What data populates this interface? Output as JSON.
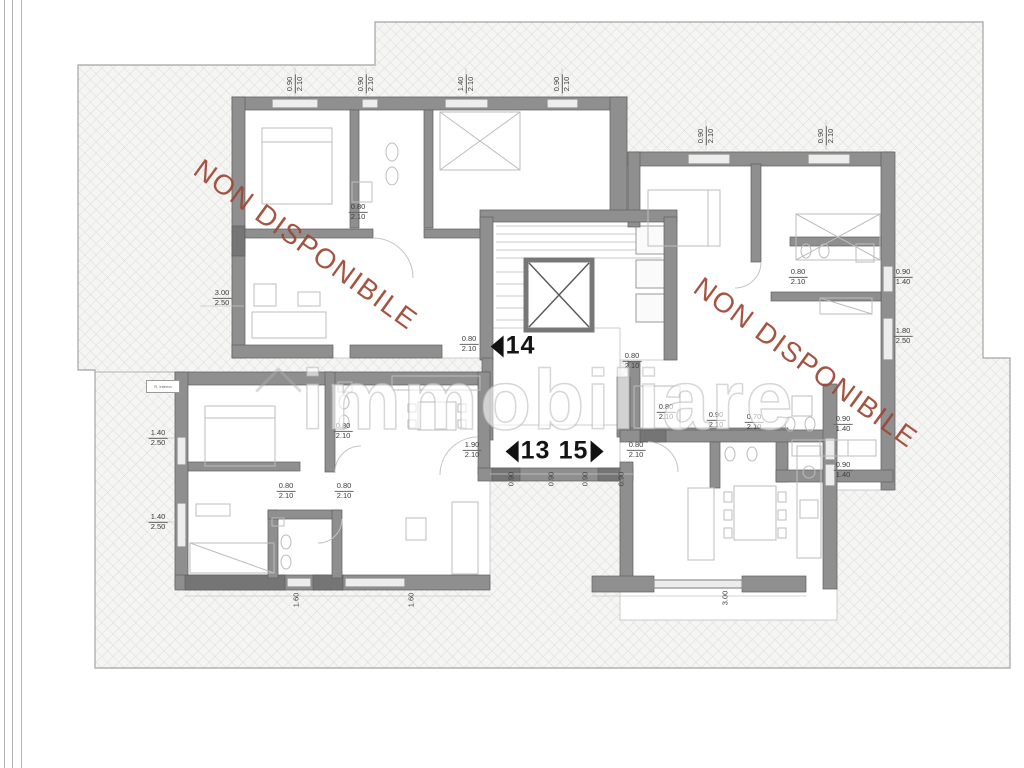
{
  "watermarks": {
    "unavailable": {
      "text": "NON DISPONIBILE",
      "color": "#9d4733"
    },
    "brand": {
      "text": "immobiliare"
    }
  },
  "plan": {
    "reference_box": {
      "text": "R. interno"
    },
    "units": [
      {
        "label": "14",
        "arrow": "left",
        "x": 513,
        "y": 346
      },
      {
        "label": "13",
        "arrow": "left",
        "x": 528,
        "y": 451
      },
      {
        "label": "15",
        "arrow": "right",
        "x": 581,
        "y": 451
      }
    ],
    "dimensions": [
      {
        "t": "3.00/2.50",
        "x": 222,
        "y": 298,
        "r": 0
      },
      {
        "t": "1.40/2.50",
        "x": 158,
        "y": 438,
        "r": 0
      },
      {
        "t": "1.40/2.50",
        "x": 158,
        "y": 522,
        "r": 0
      },
      {
        "t": "0.80/2.10",
        "x": 286,
        "y": 491,
        "r": 0
      },
      {
        "t": "0.80/2.10",
        "x": 344,
        "y": 491,
        "r": 0
      },
      {
        "t": "0.80/2.10",
        "x": 343,
        "y": 431,
        "r": 0
      },
      {
        "t": "0.80/2.10",
        "x": 469,
        "y": 344,
        "r": 0
      },
      {
        "t": "1.90/2.10",
        "x": 472,
        "y": 450,
        "r": 0
      },
      {
        "t": "0.80/2.10",
        "x": 636,
        "y": 450,
        "r": 0
      },
      {
        "t": "0.80/2.10",
        "x": 632,
        "y": 361,
        "r": 0
      },
      {
        "t": "0.80/2.10",
        "x": 666,
        "y": 412,
        "r": 0
      },
      {
        "t": "0.80/2.10",
        "x": 358,
        "y": 212,
        "r": 0
      },
      {
        "t": "0.80/2.10",
        "x": 798,
        "y": 277,
        "r": 0
      },
      {
        "t": "0.90/1.40",
        "x": 903,
        "y": 277,
        "r": 0
      },
      {
        "t": "1.80/2.50",
        "x": 903,
        "y": 336,
        "r": 0
      },
      {
        "t": "0.90/2.10",
        "x": 716,
        "y": 420,
        "r": 0
      },
      {
        "t": "0.70/2.10",
        "x": 754,
        "y": 422,
        "r": 0
      },
      {
        "t": "0.90/1.40",
        "x": 843,
        "y": 424,
        "r": 0
      },
      {
        "t": "0.90/1.40",
        "x": 843,
        "y": 470,
        "r": 0
      },
      {
        "t": "0.90/2.10",
        "x": 295,
        "y": 84,
        "r": -90
      },
      {
        "t": "0.90/2.10",
        "x": 366,
        "y": 84,
        "r": -90
      },
      {
        "t": "1.40/2.10",
        "x": 466,
        "y": 84,
        "r": -90
      },
      {
        "t": "0.90/2.10",
        "x": 562,
        "y": 84,
        "r": -90
      },
      {
        "t": "0.90/2.10",
        "x": 706,
        "y": 136,
        "r": -90
      },
      {
        "t": "0.90/2.10",
        "x": 826,
        "y": 136,
        "r": -90
      },
      {
        "t": "0.90",
        "x": 512,
        "y": 479,
        "r": -90
      },
      {
        "t": "0.90",
        "x": 552,
        "y": 479,
        "r": -90
      },
      {
        "t": "0.90",
        "x": 586,
        "y": 479,
        "r": -90
      },
      {
        "t": "0.90",
        "x": 622,
        "y": 479,
        "r": -90
      },
      {
        "t": "3.00",
        "x": 726,
        "y": 598,
        "r": -90
      },
      {
        "t": "1.60",
        "x": 297,
        "y": 600,
        "r": -90
      },
      {
        "t": "1.60",
        "x": 412,
        "y": 600,
        "r": -90
      }
    ],
    "colors": {
      "wall": "#8f8f8f",
      "wall_dark": "#757575",
      "window": "#ededed",
      "hatch_bg": "#f5f5f4",
      "hatch_line": "#dcdcda",
      "boundary": "#a3a3a3",
      "furniture": "#bdbdbd",
      "dimension_text": "#3c3c3c",
      "unit_text": "#141414",
      "watermark_red": "#9d4733"
    }
  }
}
